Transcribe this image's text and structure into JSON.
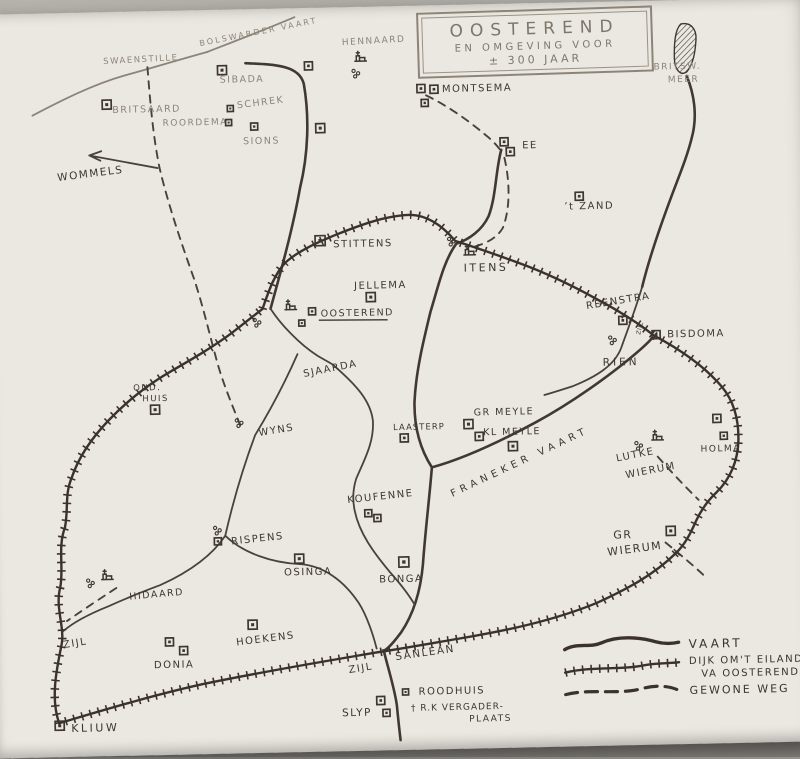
{
  "title_box": {
    "line1": "OOSTEREND",
    "line2": "EN OMGEVING VOOR",
    "line3": "± 300 JAAR"
  },
  "legend": {
    "entries": [
      {
        "label": "VAART",
        "line_style": "solid-wavy"
      },
      {
        "label": "DIJK OM'T EILAND",
        "label2": "VA OOSTEREND",
        "line_style": "hatched"
      },
      {
        "label": "GEWONE WEG",
        "line_style": "dashed"
      }
    ]
  },
  "colors": {
    "ink": "#3e372e",
    "faded_ink": "#8d8479",
    "paper": "#ebe8e1",
    "photo_background": "#a5a29c"
  },
  "map": {
    "labels": [
      {
        "t": "SWAENSTILLE",
        "x": 110,
        "y": 58,
        "s": 8.5,
        "r": -2,
        "f": 1
      },
      {
        "t": "BOLSWARDER VAART",
        "x": 207,
        "y": 42,
        "s": 8,
        "r": -10,
        "f": 1,
        "ls": 2.2
      },
      {
        "t": "SIBADA",
        "x": 226,
        "y": 79,
        "s": 9.5,
        "f": 1
      },
      {
        "t": "BRITSAARD",
        "x": 118,
        "y": 107,
        "s": 9.5,
        "f": 1
      },
      {
        "t": "ROORDEMA",
        "x": 168,
        "y": 121,
        "s": 9,
        "f": 1
      },
      {
        "t": "SCHREK",
        "x": 243,
        "y": 105,
        "s": 9.5,
        "r": -6,
        "f": 1
      },
      {
        "t": "SIONS",
        "x": 248,
        "y": 141,
        "s": 9.5,
        "f": 1
      },
      {
        "t": "WOMMELS",
        "x": 62,
        "y": 174,
        "s": 10.5,
        "r": -6
      },
      {
        "t": "HENNAARD",
        "x": 349,
        "y": 44,
        "s": 9,
        "r": -2,
        "f": 1
      },
      {
        "t": "BRITSW.",
        "x": 660,
        "y": 75,
        "s": 9,
        "f": 1
      },
      {
        "t": "MEER",
        "x": 674,
        "y": 88,
        "s": 9,
        "f": 1
      },
      {
        "t": "MONTSEMA",
        "x": 448,
        "y": 93,
        "s": 10
      },
      {
        "t": "EE",
        "x": 527,
        "y": 151,
        "s": 10
      },
      {
        "t": "’t ZAND",
        "x": 568,
        "y": 213,
        "s": 10
      },
      {
        "t": "STITTENS",
        "x": 336,
        "y": 246,
        "s": 10
      },
      {
        "t": "ITENS",
        "x": 466,
        "y": 273,
        "s": 11,
        "ls": 2.5
      },
      {
        "t": "JELLEMA",
        "x": 356,
        "y": 288,
        "s": 10
      },
      {
        "t": "OOSTEREND",
        "x": 322,
        "y": 315,
        "s": 9.5,
        "u": 1
      },
      {
        "t": "REENSTRA",
        "x": 588,
        "y": 313,
        "s": 10,
        "r": -8
      },
      {
        "t": "BISDOMA",
        "x": 668,
        "y": 343,
        "s": 10
      },
      {
        "t": "ZIJL",
        "x": 641,
        "y": 340,
        "s": 6,
        "r": -75,
        "n": "zijl-bisdoma",
        "ls": 0.5
      },
      {
        "t": "RIEN",
        "x": 603,
        "y": 370,
        "s": 10.5,
        "ls": 3
      },
      {
        "t": "OUD.",
        "x": 133,
        "y": 385,
        "s": 8.5
      },
      {
        "t": "HUIS",
        "x": 142,
        "y": 396,
        "s": 8.5
      },
      {
        "t": "SJAARDA",
        "x": 304,
        "y": 375,
        "s": 10,
        "r": -10
      },
      {
        "t": "WYNS",
        "x": 258,
        "y": 433,
        "s": 10,
        "r": -8
      },
      {
        "t": "LAASTERP",
        "x": 392,
        "y": 430,
        "s": 8.5,
        "ls": 1
      },
      {
        "t": "GR MEYLE",
        "x": 473,
        "y": 417,
        "s": 9.5
      },
      {
        "t": "KL MEYLE",
        "x": 482,
        "y": 437,
        "s": 9.5
      },
      {
        "t": "FRANEKER VAART",
        "x": 450,
        "y": 498,
        "s": 10,
        "r": -24,
        "ls": 4.5
      },
      {
        "t": "LUTKE",
        "x": 615,
        "y": 466,
        "s": 10,
        "r": -10
      },
      {
        "t": "WIERUM",
        "x": 624,
        "y": 483,
        "s": 10,
        "r": -10,
        "n": "wierum-lutke"
      },
      {
        "t": "HOLMA",
        "x": 699,
        "y": 458,
        "s": 9
      },
      {
        "t": "GR",
        "x": 610,
        "y": 543,
        "s": 11
      },
      {
        "t": "WIERUM",
        "x": 604,
        "y": 560,
        "s": 11,
        "r": -6,
        "n": "wierum-gr"
      },
      {
        "t": "KOUFENNE",
        "x": 345,
        "y": 502,
        "s": 10,
        "r": -5
      },
      {
        "t": "RISPENS",
        "x": 228,
        "y": 541,
        "s": 10,
        "r": -5
      },
      {
        "t": "OSINGA",
        "x": 280,
        "y": 573,
        "s": 10
      },
      {
        "t": "BONGA",
        "x": 375,
        "y": 582,
        "s": 10
      },
      {
        "t": "HIDAARD",
        "x": 125,
        "y": 594,
        "s": 9.5,
        "r": -4
      },
      {
        "t": "ZIJL",
        "x": 58,
        "y": 641,
        "s": 10,
        "r": -8,
        "n": "zijl-west"
      },
      {
        "t": "HOEKENS",
        "x": 231,
        "y": 642,
        "s": 10,
        "r": -6
      },
      {
        "t": "DONIA",
        "x": 148,
        "y": 663,
        "s": 10
      },
      {
        "t": "ZIJL",
        "x": 343,
        "y": 672,
        "s": 10,
        "r": -8,
        "n": "zijl-sanlean"
      },
      {
        "t": "SANLEAN",
        "x": 390,
        "y": 660,
        "s": 10.5,
        "r": -7
      },
      {
        "t": "ROODHUIS",
        "x": 412,
        "y": 695,
        "s": 10
      },
      {
        "t": "† R.K VERGADER-",
        "x": 404,
        "y": 711,
        "s": 9,
        "ls": 1
      },
      {
        "t": "PLAATS",
        "x": 462,
        "y": 723,
        "s": 9
      },
      {
        "t": "SLYP",
        "x": 335,
        "y": 715,
        "s": 10.5
      },
      {
        "t": "KLIUW",
        "x": 64,
        "y": 725,
        "s": 11,
        "ls": 2.5
      }
    ],
    "symbols": [
      {
        "k": "sq",
        "x": 108,
        "y": 94,
        "s": 9
      },
      {
        "k": "sq",
        "x": 224,
        "y": 62,
        "s": 9
      },
      {
        "k": "sq",
        "x": 233,
        "y": 102,
        "s": 6
      },
      {
        "k": "sq",
        "x": 231,
        "y": 116,
        "s": 6
      },
      {
        "k": "sq",
        "x": 256,
        "y": 120,
        "s": 7
      },
      {
        "k": "sq",
        "x": 311,
        "y": 60,
        "s": 8
      },
      {
        "k": "sq",
        "x": 321,
        "y": 122,
        "s": 9
      },
      {
        "k": "sq",
        "x": 423,
        "y": 85,
        "s": 8
      },
      {
        "k": "sq",
        "x": 436,
        "y": 86,
        "s": 8
      },
      {
        "k": "sq",
        "x": 427,
        "y": 100,
        "s": 7
      },
      {
        "k": "sq",
        "x": 505,
        "y": 140,
        "s": 8
      },
      {
        "k": "sq",
        "x": 511,
        "y": 150,
        "s": 8
      },
      {
        "k": "sq",
        "x": 579,
        "y": 196,
        "s": 8
      },
      {
        "k": "sq",
        "x": 318,
        "y": 234,
        "s": 10
      },
      {
        "k": "sq",
        "x": 368,
        "y": 292,
        "s": 9
      },
      {
        "k": "sq",
        "x": 310,
        "y": 306,
        "s": 7
      },
      {
        "k": "sq",
        "x": 300,
        "y": 318,
        "s": 6
      },
      {
        "k": "sq",
        "x": 620,
        "y": 321,
        "s": 8
      },
      {
        "k": "sq",
        "x": 653,
        "y": 336,
        "s": 8
      },
      {
        "k": "sq",
        "x": 399,
        "y": 434,
        "s": 8
      },
      {
        "k": "sq",
        "x": 463,
        "y": 421,
        "s": 9
      },
      {
        "k": "sq",
        "x": 474,
        "y": 434,
        "s": 8
      },
      {
        "k": "sq",
        "x": 507,
        "y": 444,
        "s": 9
      },
      {
        "k": "sq",
        "x": 712,
        "y": 421,
        "s": 8
      },
      {
        "k": "sq",
        "x": 719,
        "y": 439,
        "s": 7
      },
      {
        "k": "sq",
        "x": 663,
        "y": 532,
        "s": 9
      },
      {
        "k": "sq",
        "x": 362,
        "y": 509,
        "s": 7
      },
      {
        "k": "sq",
        "x": 371,
        "y": 514,
        "s": 7
      },
      {
        "k": "sq",
        "x": 211,
        "y": 534,
        "s": 7
      },
      {
        "k": "sq",
        "x": 291,
        "y": 552,
        "s": 9
      },
      {
        "k": "sq",
        "x": 395,
        "y": 557,
        "s": 10
      },
      {
        "k": "sq",
        "x": 243,
        "y": 617,
        "s": 9
      },
      {
        "k": "sq",
        "x": 160,
        "y": 633,
        "s": 8
      },
      {
        "k": "sq",
        "x": 174,
        "y": 642,
        "s": 8
      },
      {
        "k": "sq",
        "x": 48,
        "y": 714,
        "s": 9
      },
      {
        "k": "sq",
        "x": 396,
        "y": 689,
        "s": 6
      },
      {
        "k": "sq",
        "x": 370,
        "y": 696,
        "s": 8
      },
      {
        "k": "sq",
        "x": 376,
        "y": 709,
        "s": 7
      },
      {
        "k": "sq",
        "x": 150,
        "y": 400,
        "s": 9
      },
      {
        "k": "ch",
        "x": 363,
        "y": 52
      },
      {
        "k": "ch",
        "x": 468,
        "y": 248
      },
      {
        "k": "ch",
        "x": 288,
        "y": 299
      },
      {
        "k": "ch",
        "x": 99,
        "y": 565
      },
      {
        "k": "ch",
        "x": 652,
        "y": 437
      },
      {
        "k": "dots",
        "x": 360,
        "y": 70
      },
      {
        "k": "dots",
        "x": 452,
        "y": 240
      },
      {
        "k": "dots",
        "x": 256,
        "y": 317
      },
      {
        "k": "dots",
        "x": 236,
        "y": 417
      },
      {
        "k": "dots",
        "x": 611,
        "y": 342
      },
      {
        "k": "dots",
        "x": 635,
        "y": 448
      },
      {
        "k": "dots",
        "x": 84,
        "y": 574
      },
      {
        "k": "dots",
        "x": 212,
        "y": 524
      }
    ]
  }
}
